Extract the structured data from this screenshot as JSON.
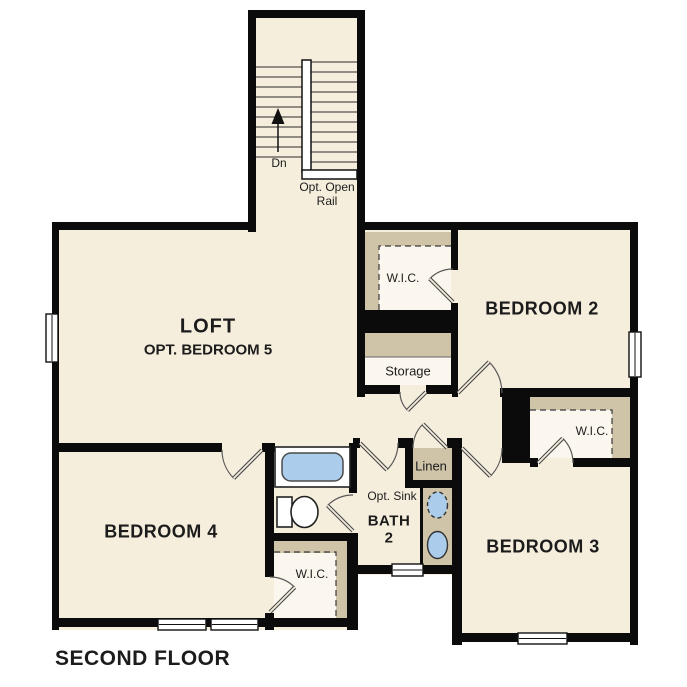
{
  "page_title": "SECOND FLOOR",
  "colors": {
    "wall": "#0b0b0b",
    "room": "#f6eedd",
    "closet": "#fbf7ee",
    "shelf": "#cfc3a8",
    "fixture_blue": "#abccea",
    "text": "#1c1c1c",
    "background": "#ffffff"
  },
  "stairwell": {
    "down_label": "Dn",
    "rail_note_line1": "Opt. Open",
    "rail_note_line2": "Rail"
  },
  "rooms": {
    "loft": {
      "name": "LOFT",
      "option": "OPT. BEDROOM 5"
    },
    "bedroom2": {
      "name": "BEDROOM 2",
      "closet_label": "W.I.C."
    },
    "bedroom3": {
      "name": "BEDROOM 3",
      "closet_label": "W.I.C."
    },
    "bedroom4": {
      "name": "BEDROOM 4",
      "closet_label": "W.I.C."
    },
    "bath": {
      "name_line1": "BATH",
      "name_line2": "2",
      "opt_sink_label": "Opt. Sink"
    },
    "storage": {
      "name": "Storage"
    },
    "linen": {
      "name": "Linen"
    }
  }
}
